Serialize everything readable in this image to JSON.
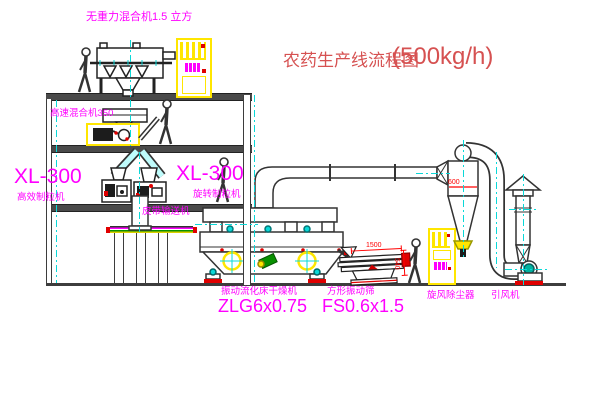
{
  "title": {
    "text": "农药生产线流程图",
    "capacity": "(500kg/h)"
  },
  "labels": {
    "gravity_mixer": "无重力混合机1.5 立方",
    "high_speed_mixer": "高速混合机350",
    "granulator_left_model": "XL-300",
    "granulator_left_name": "高效制粒机",
    "granulator_right_model": "XL-300",
    "granulator_right_name": "旋转制粒机",
    "belt_conveyor": "皮带输送机",
    "dryer_name": "振动流化床干燥机",
    "dryer_model": "ZLG6x0.75",
    "screen_name": "方形振动筛",
    "screen_model": "FS0.6x1.5",
    "cyclone": "旋风除尘器",
    "fan": "引风机"
  },
  "dimensions": {
    "cyclone_diameter": "600",
    "screen_length": "1500",
    "screen_height": "540"
  },
  "colors": {
    "label_magenta": "#ff00ff",
    "title_red": "#d65151",
    "dimension_red": "#ff0000",
    "centerline_cyan": "#0ad8d8",
    "highlight_yellow": "#ffe600",
    "structure_gray": "#3d3d3d"
  }
}
